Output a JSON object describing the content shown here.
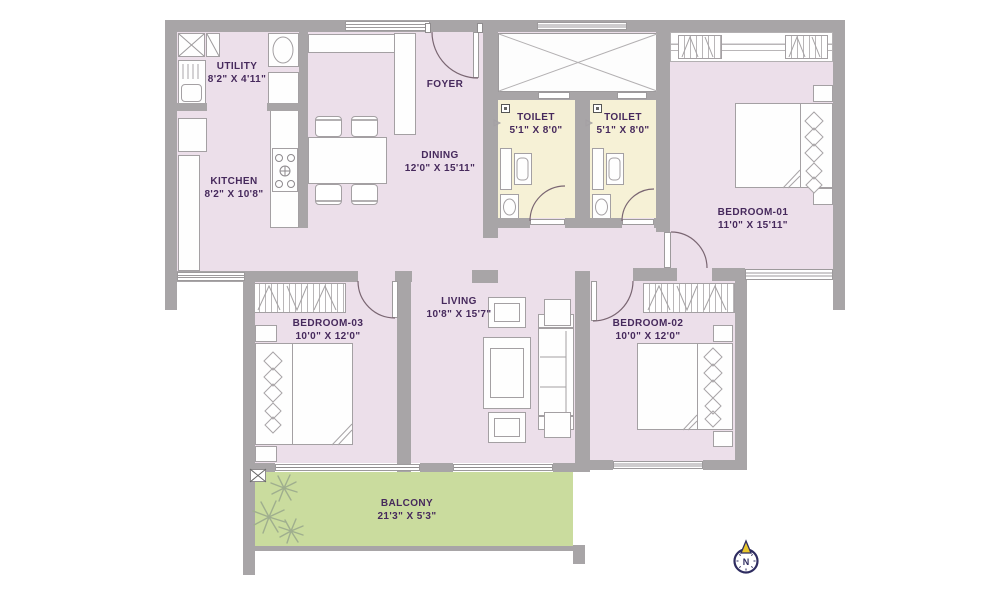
{
  "plan_title": "3 BHK apartment floor plan",
  "rooms": [
    {
      "id": "utility",
      "name": "UTILITY",
      "dims": "8'2\" X 4'11\""
    },
    {
      "id": "kitchen",
      "name": "KITCHEN",
      "dims": "8'2\" X 10'8\""
    },
    {
      "id": "foyer",
      "name": "FOYER",
      "dims": ""
    },
    {
      "id": "dining",
      "name": "DINING",
      "dims": "12'0\" X 15'11\""
    },
    {
      "id": "toilet-1",
      "name": "TOILET",
      "dims": "5'1\" X 8'0\""
    },
    {
      "id": "toilet-2",
      "name": "TOILET",
      "dims": "5'1\" X 8'0\""
    },
    {
      "id": "bedroom-01",
      "name": "BEDROOM-01",
      "dims": "11'0\" X 15'11\""
    },
    {
      "id": "bedroom-03",
      "name": "BEDROOM-03",
      "dims": "10'0\" X 12'0\""
    },
    {
      "id": "living",
      "name": "LIVING",
      "dims": "10'8\" X 15'7\""
    },
    {
      "id": "bedroom-02",
      "name": "BEDROOM-02",
      "dims": "10'0\" X 12'0\""
    },
    {
      "id": "balcony",
      "name": "BALCONY",
      "dims": "21'3\" X 5'3\""
    }
  ],
  "compass": {
    "label": "N"
  },
  "colors": {
    "wall": "#a8a5a7",
    "floor": "#ecdfea",
    "toilet_floor": "#f6f1d6",
    "balcony_floor": "#cadc9e",
    "label_text": "#46295c",
    "compass_navy": "#2e2c60",
    "compass_gold": "#e8c62c"
  }
}
